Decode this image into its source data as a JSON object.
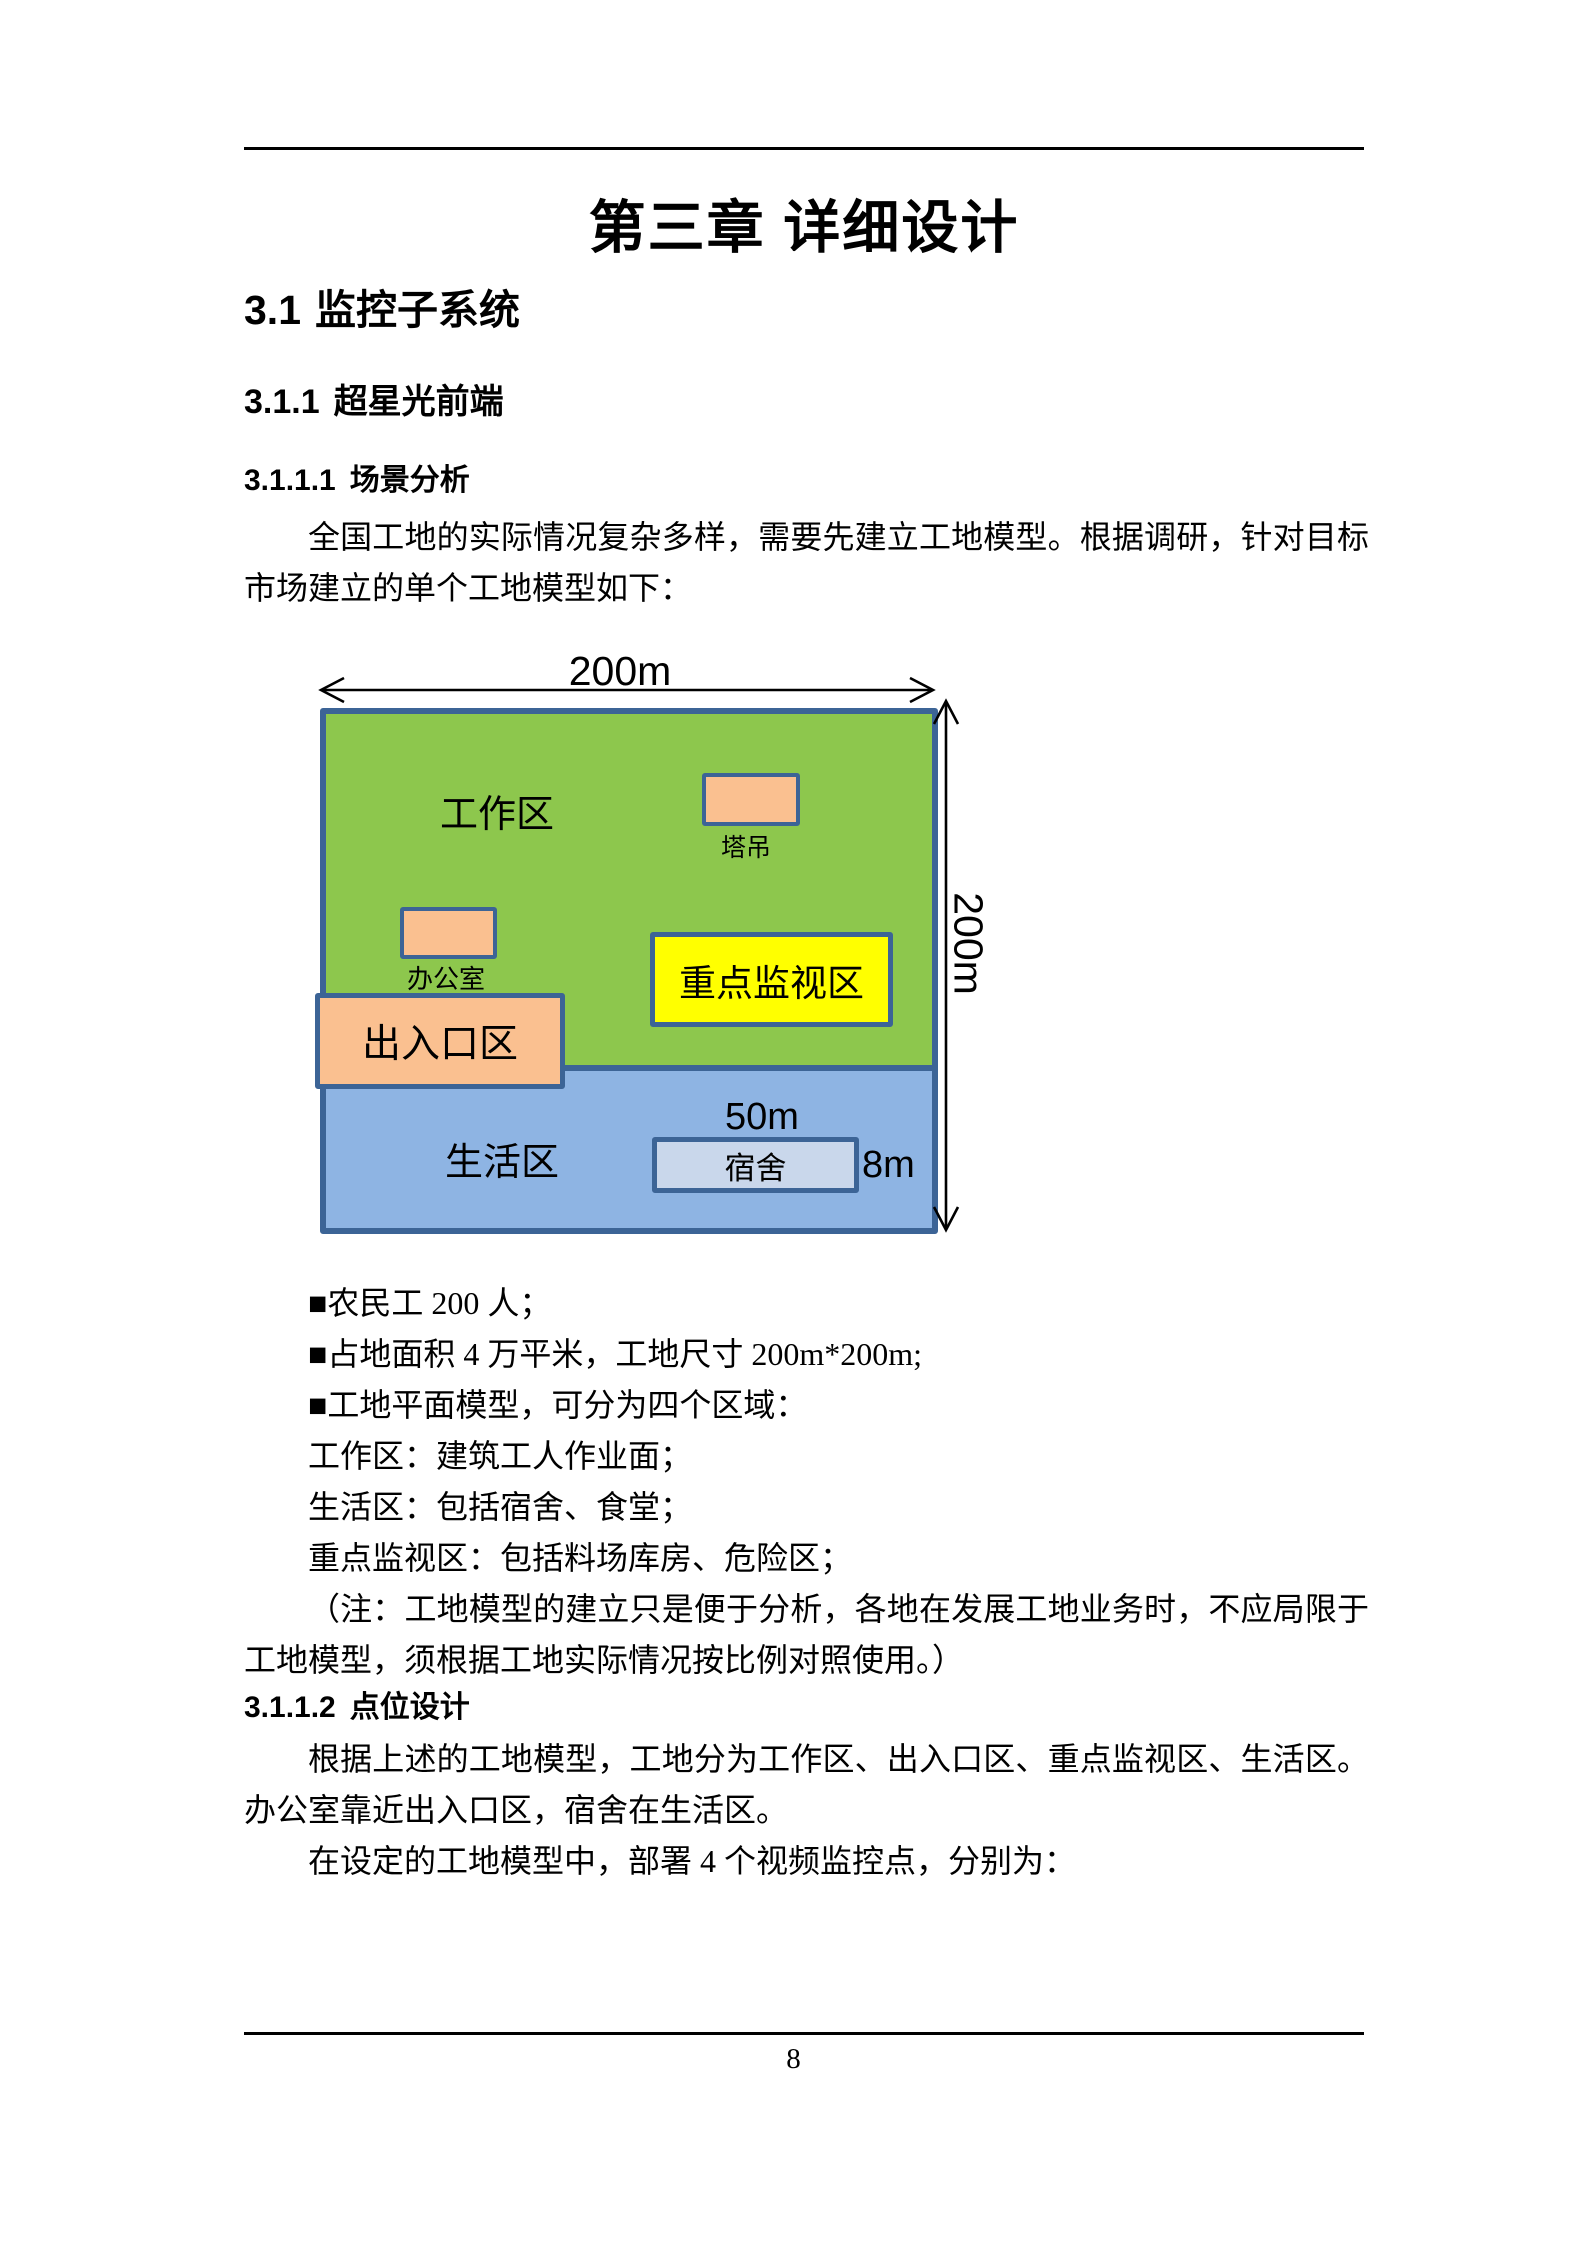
{
  "theme": {
    "zone_green": "#8DC74D",
    "zone_blue": "#8EB4E3",
    "building_peach": "#FAC090",
    "highlight_yellow": "#FFFF00",
    "dorm_blue": "#C9D7EB",
    "border_blue": "#3C6496"
  },
  "title": "第三章 详细设计",
  "headings": {
    "h2_num": "3.1",
    "h2_text": "监控子系统",
    "h3_num": "3.1.1",
    "h3_text": "超星光前端",
    "h4_scene_num": "3.1.1.1",
    "h4_scene_text": "场景分析",
    "h4_points_num": "3.1.1.2",
    "h4_points_text": "点位设计"
  },
  "paragraphs": {
    "intro": "全国工地的实际情况复杂多样，需要先建立工地模型。根据调研，针对目标市场建立的单个工地模型如下：",
    "note": "（注：工地模型的建立只是便于分析，各地在发展工地业务时，不应局限于工地模型，须根据工地实际情况按比例对照使用。）",
    "design_1": "根据上述的工地模型，工地分为工作区、出入口区、重点监视区、生活区。办公室靠近出入口区，宿舍在生活区。",
    "design_2": "在设定的工地模型中，部署 4 个视频监控点，分别为："
  },
  "bullets": [
    "■农民工 200 人；",
    "■占地面积 4 万平米，工地尺寸 200m*200m;",
    "■工地平面模型，可分为四个区域：",
    "工作区：建筑工人作业面；",
    "生活区：包括宿舍、食堂；",
    "重点监视区：包括料场库房、危险区；"
  ],
  "diagram": {
    "site_width_label": "200m",
    "site_height_label": "200m",
    "zones": {
      "work": "工作区",
      "entrance": "出入口区",
      "key_surveillance": "重点监视区",
      "living": "生活区"
    },
    "buildings": {
      "tower_crane": "塔吊",
      "office": "办公室",
      "dormitory": "宿舍"
    },
    "dorm_width_label": "50m",
    "dorm_height_label": "8m"
  },
  "footer": {
    "page_number": "8"
  }
}
